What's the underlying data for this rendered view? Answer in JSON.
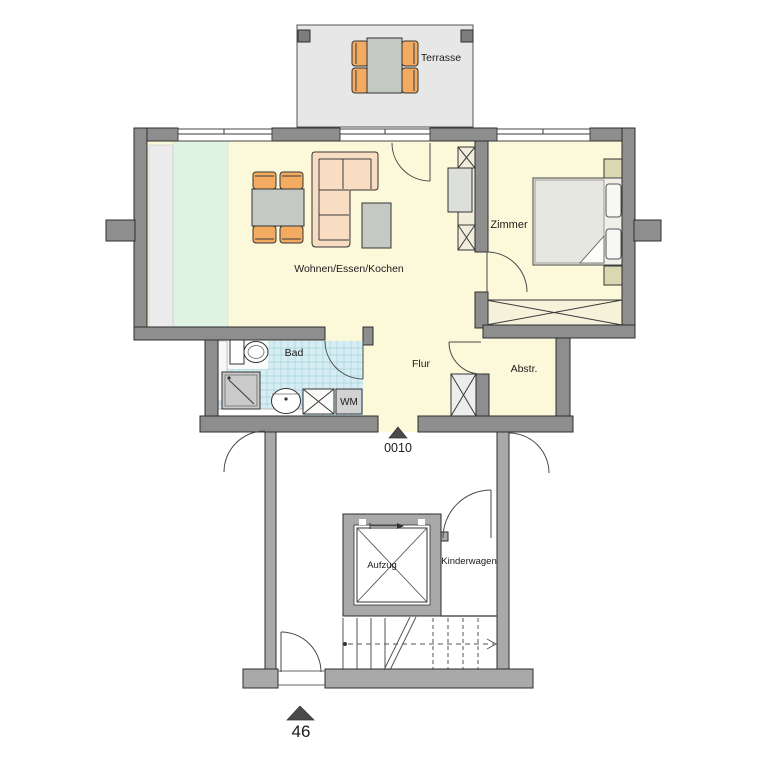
{
  "plan": {
    "rooms": [
      {
        "id": "terrace",
        "label": "Terrasse"
      },
      {
        "id": "living",
        "label": "Wohnen/Essen/Kochen"
      },
      {
        "id": "bedroom",
        "label": "Zimmer"
      },
      {
        "id": "bathroom",
        "label": "Bad"
      },
      {
        "id": "hallway",
        "label": "Flur"
      },
      {
        "id": "storage",
        "label": "Abstr."
      },
      {
        "id": "elevator",
        "label": "Aufzug"
      },
      {
        "id": "stroller",
        "label": "Kinderwagen"
      }
    ],
    "labels": {
      "washing_machine": "WM"
    },
    "markers": {
      "apartment_number": "0010",
      "level_number": "46"
    },
    "colors": {
      "wall": "#8e8e8e",
      "wall_common": "#a9a9a9",
      "room_fill": "#fcf9da",
      "kitchen_zone": "#e1f4e4",
      "tile": "#d6eef3",
      "terrace": "#e7e7e7",
      "chair_orange": "#f3ab62",
      "sofa_peach": "#f9ddc2"
    }
  }
}
